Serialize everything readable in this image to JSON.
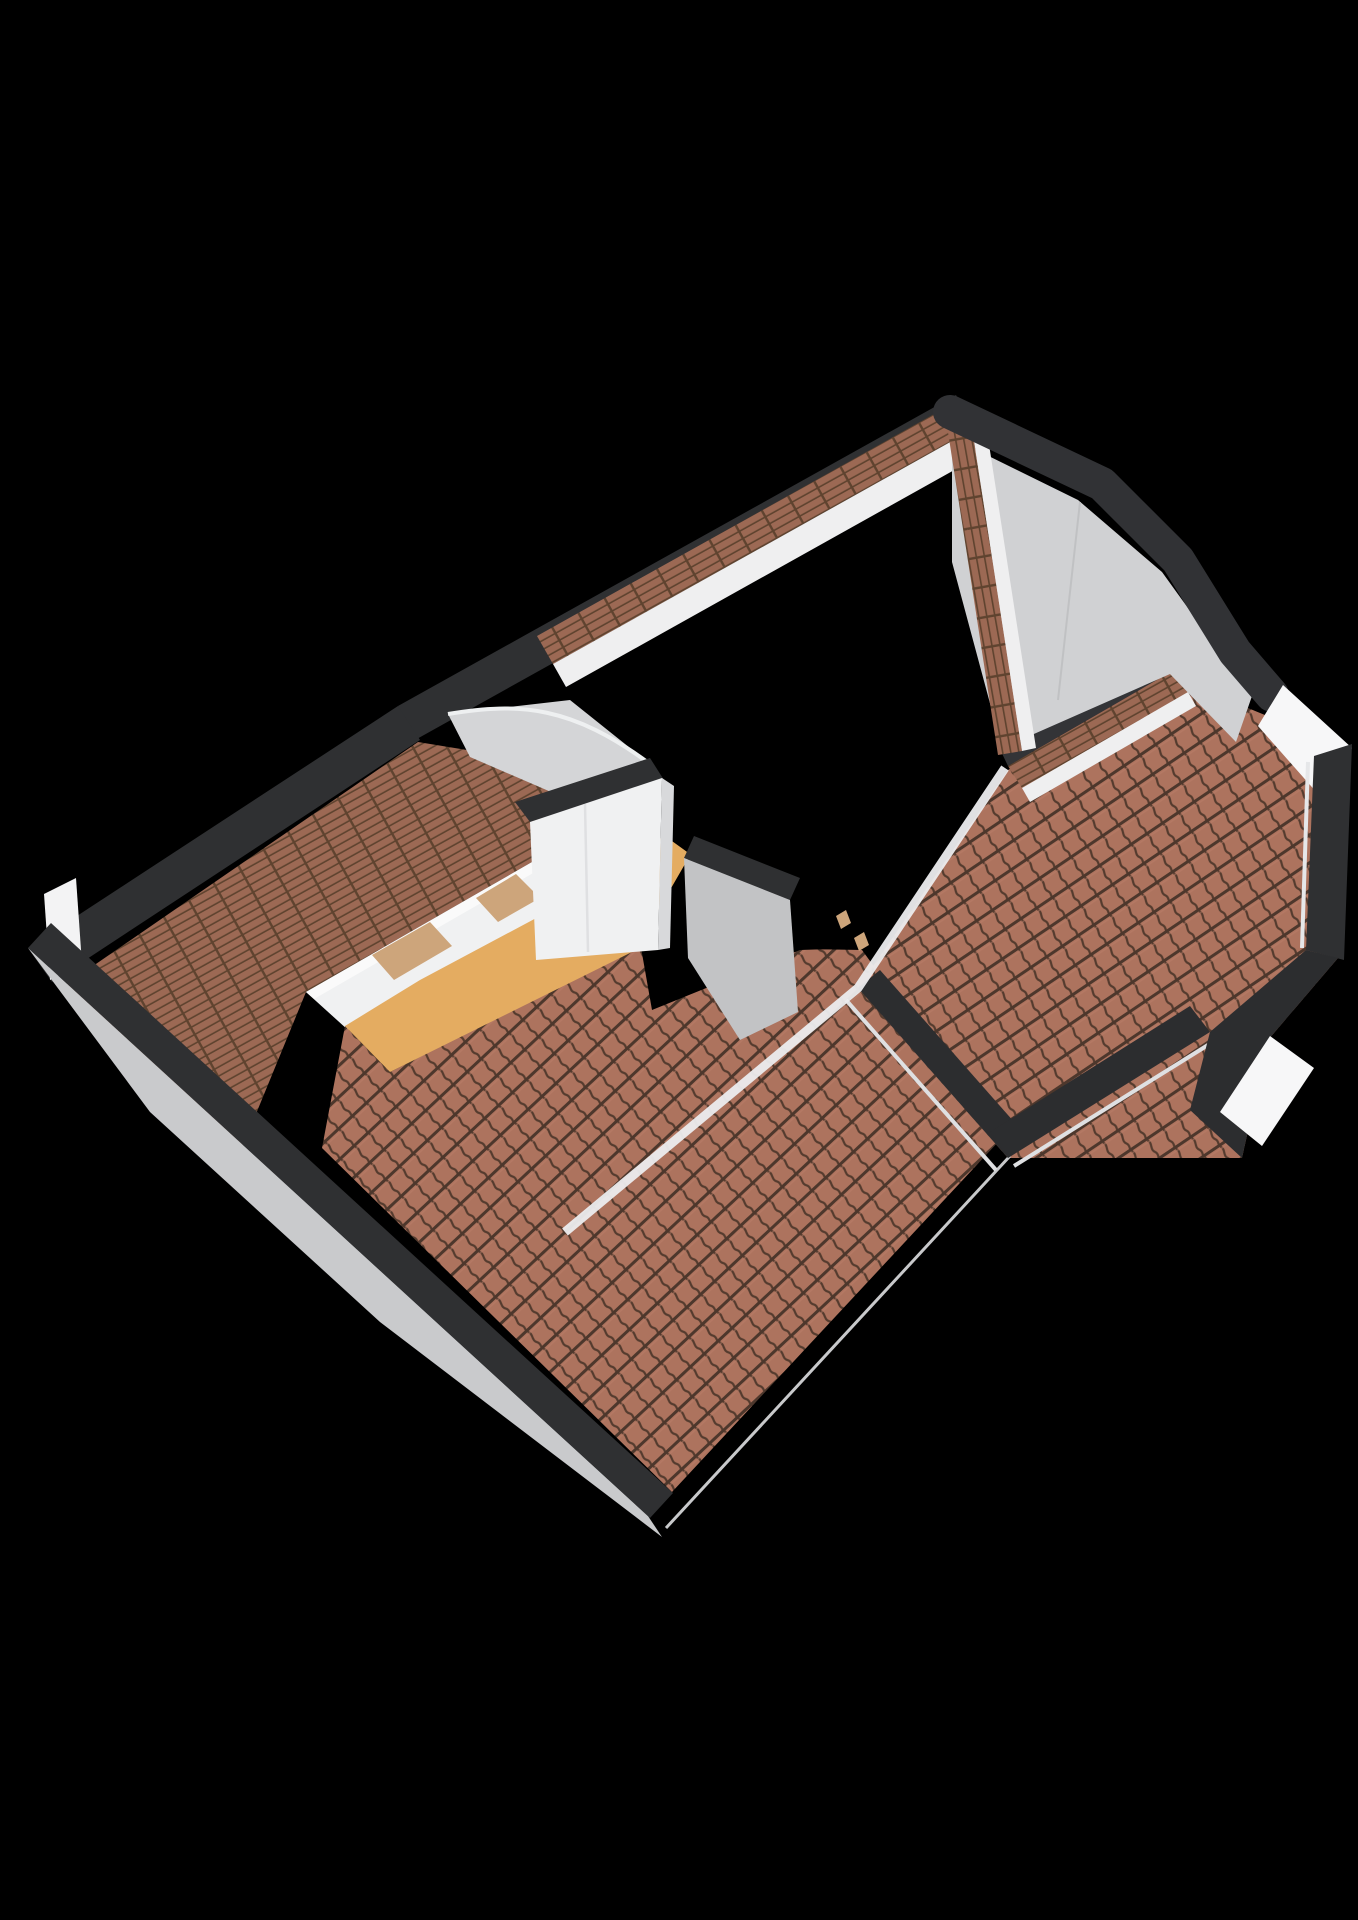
{
  "scene": {
    "title": "",
    "type": "3d-attic-floorplan-render",
    "canvas": {
      "width": 1358,
      "height": 1920
    },
    "palette": {
      "background": "#000000",
      "cut_band": "#2f3032",
      "cut_band_dark": "#2c2d2f",
      "cut_band_light": "#333437",
      "tile_front": "#ad735e",
      "tile_back": "#9c6954",
      "tile_line": "#543b2e",
      "wall_white": "#f0f1f2",
      "wall_white_bright": "#f7f7f8",
      "wall_white_dim": "#d8d9db",
      "wall_gray": "#c2c3c5",
      "gable_gray_left": "#c9cacc",
      "gable_gray_right": "#d0d1d3",
      "flashing_gray": "#d4d5d7",
      "fascia_white": "#efeff0",
      "ridge_white": "#ececee",
      "sliver_white": "#dfe0e2",
      "edge_gray": "#c8c9cb",
      "floor_orange": "#e4ac61",
      "panel_tan": "#cda57b"
    },
    "elements": [
      "roof-left-back-slope",
      "roof-front-left-slope",
      "roof-right-wing",
      "roof-rear-strip",
      "roof-strip-front-right",
      "roof-strip-gable-ridge",
      "gable-wall-left",
      "gable-wall-right",
      "attic-floor",
      "knee-wall-row",
      "interior-wall-main",
      "interior-wall-triangle",
      "stairwell-void",
      "ridge-valley-line",
      "cut-wall-bands",
      "eave-fascia-strips",
      "corner-wall-wedge-ne",
      "notch-wall-se"
    ]
  }
}
